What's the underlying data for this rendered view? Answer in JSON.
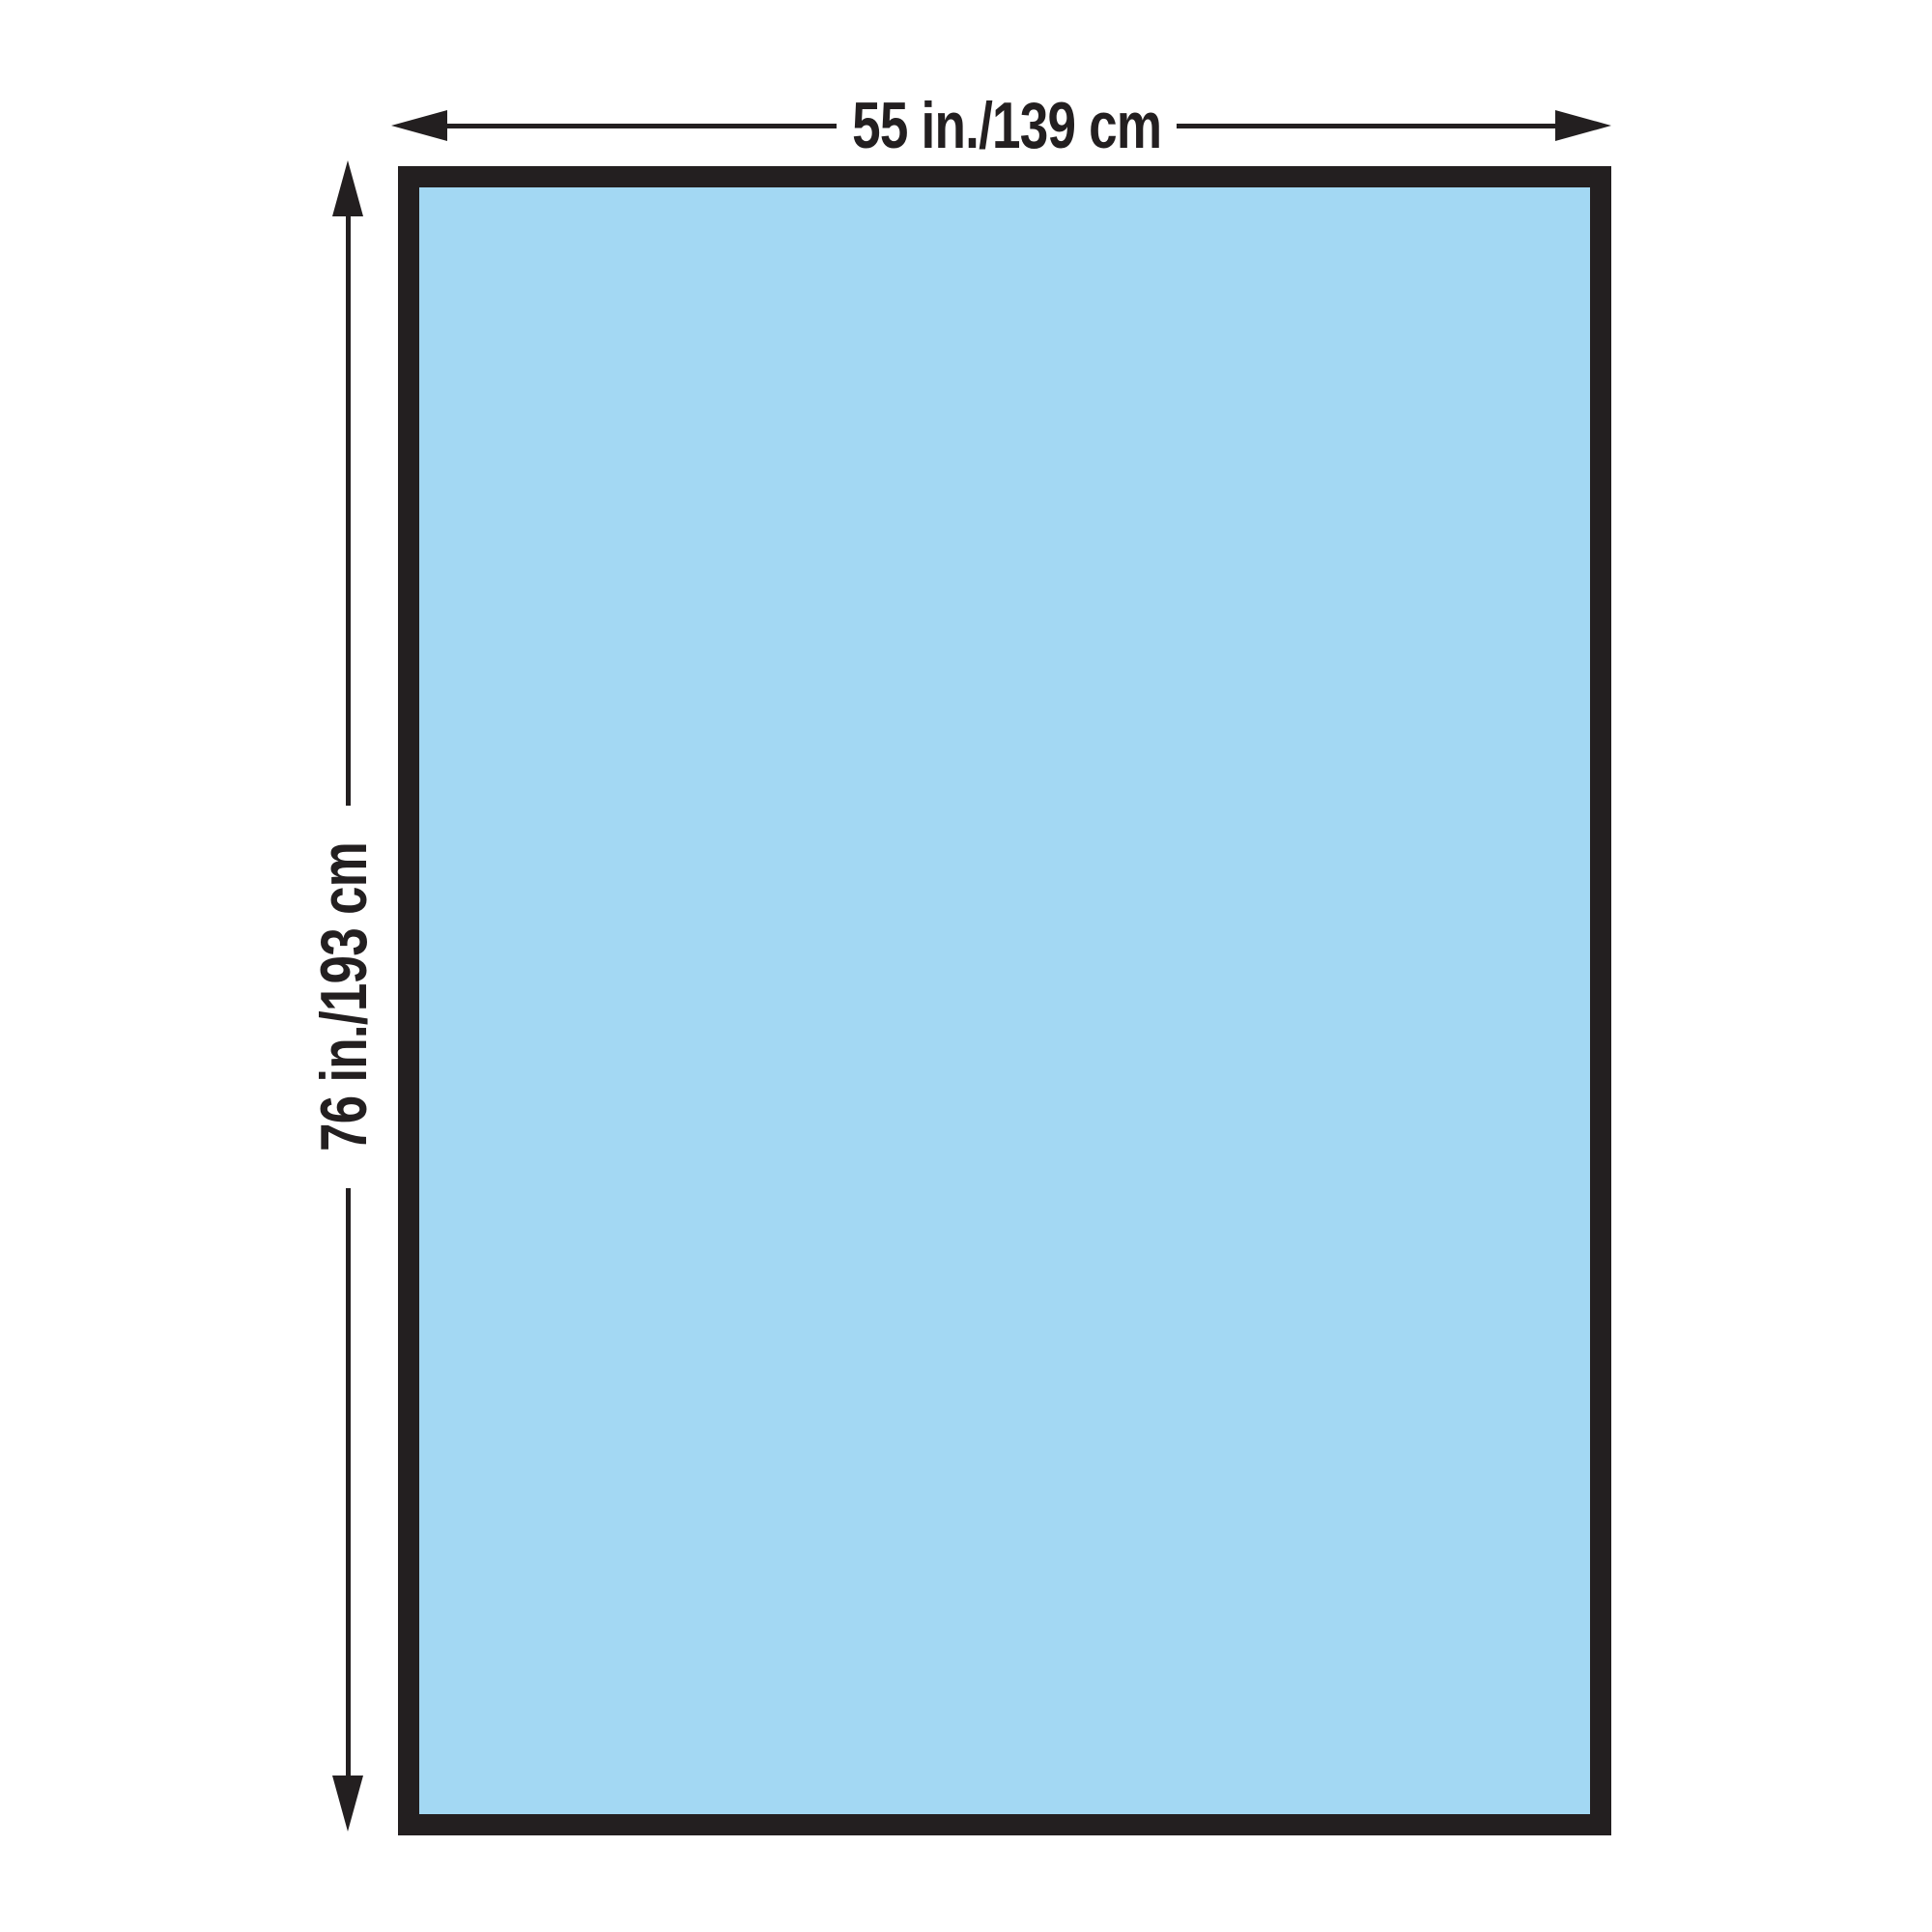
{
  "diagram": {
    "type": "product-dimension-diagram",
    "shape": "rectangle",
    "colors": {
      "fill": "#a3d8f3",
      "stroke": "#231f20",
      "background": "#ffffff"
    },
    "width_dimension": {
      "label": "55 in./139 cm"
    },
    "height_dimension": {
      "label": "76 in./193 cm"
    }
  }
}
